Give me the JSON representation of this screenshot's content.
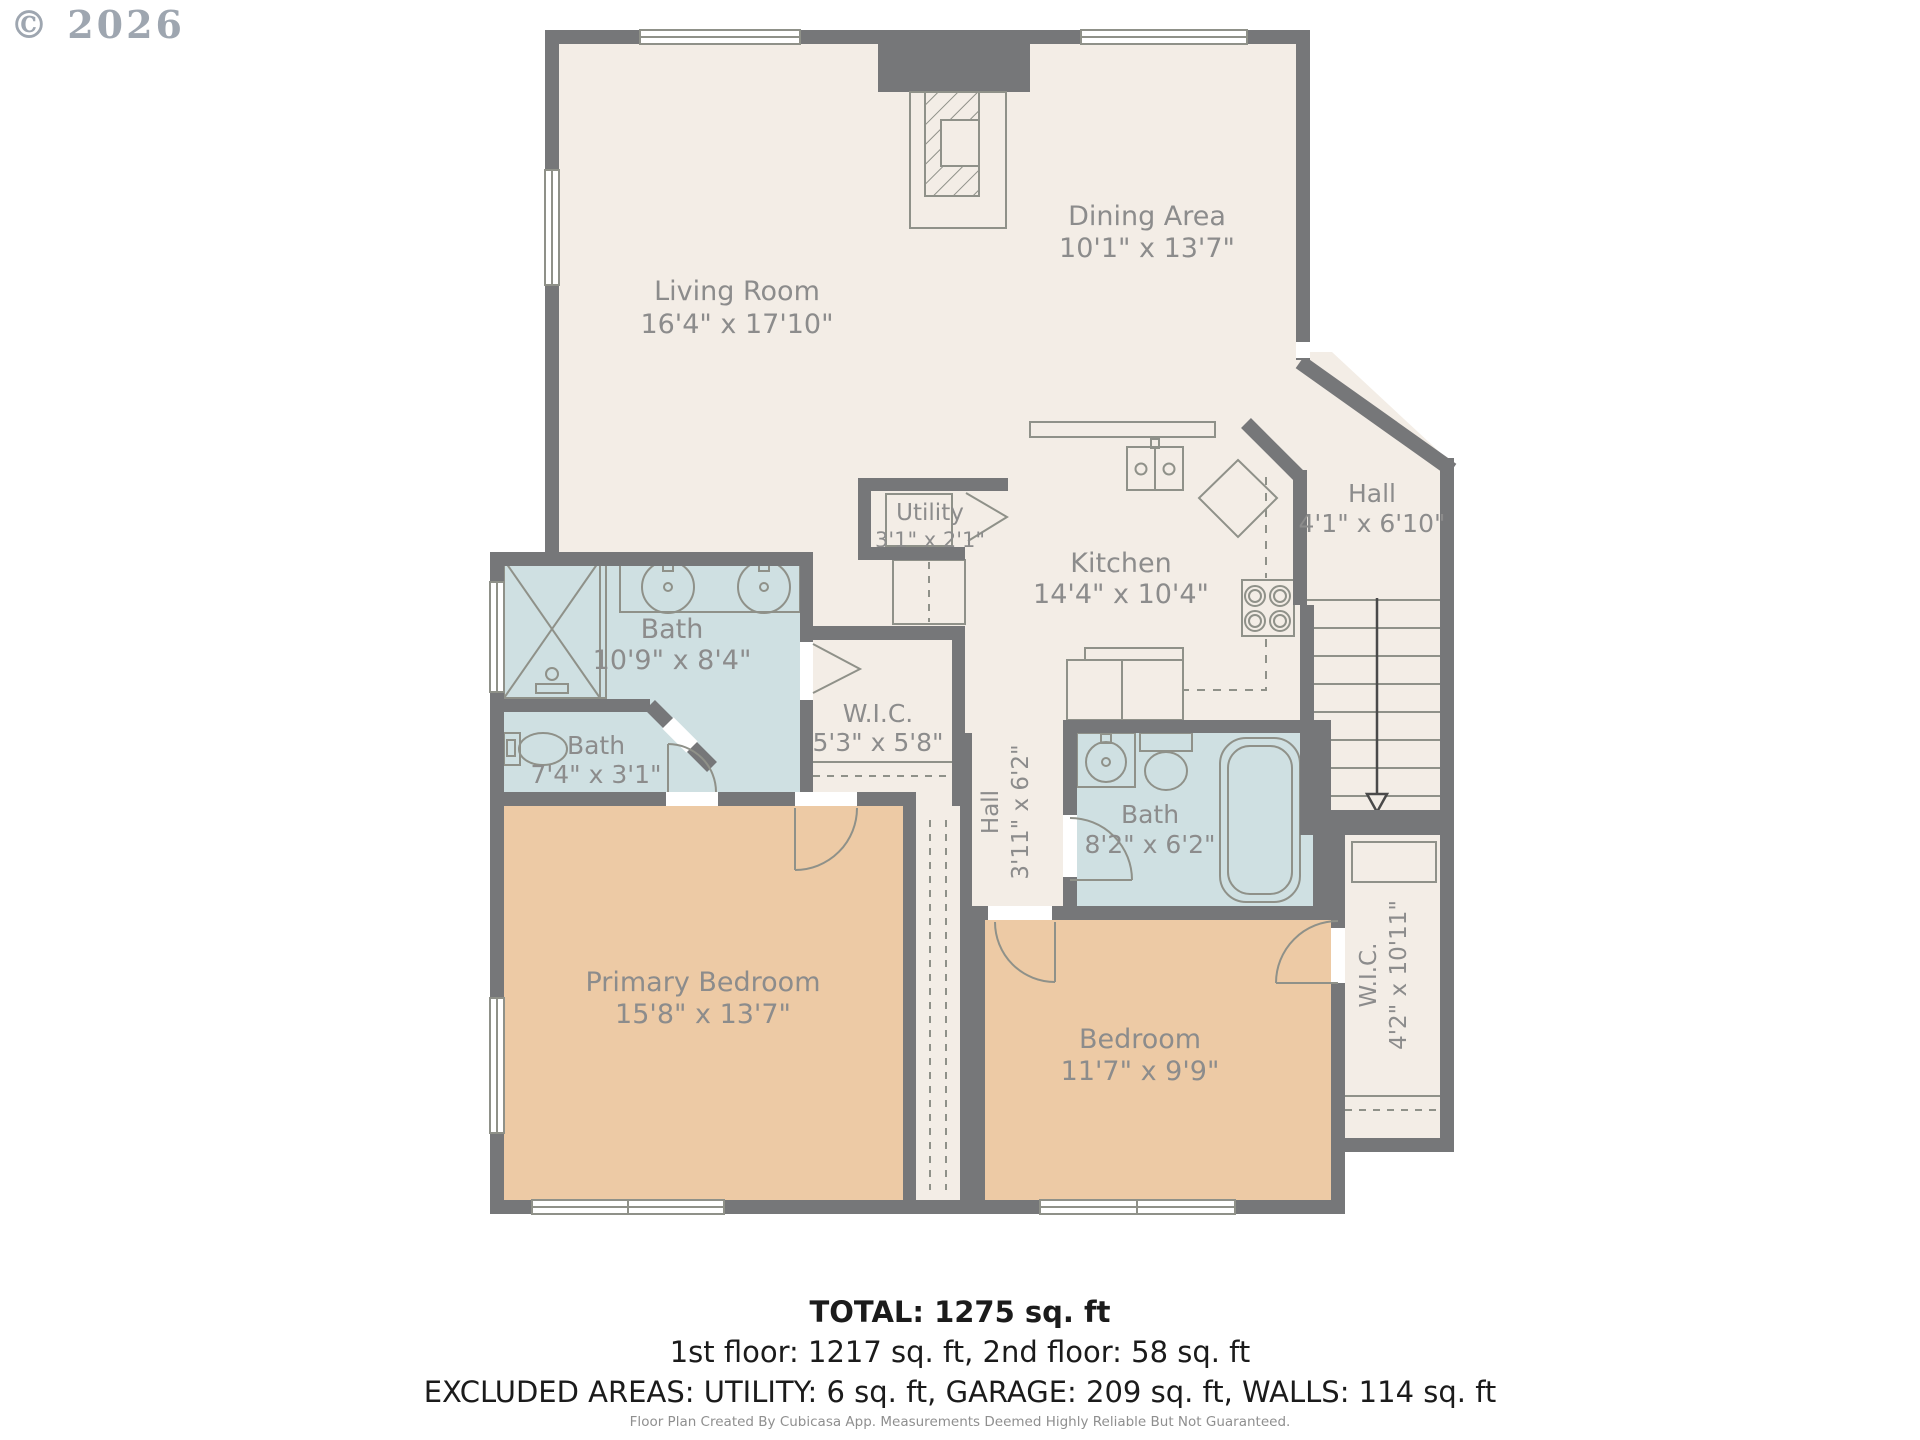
{
  "watermark": {
    "copyright": "© 2026"
  },
  "floorplan": {
    "rooms": {
      "living": {
        "name": "Living Room",
        "dims": "16'4\" x 17'10\""
      },
      "dining": {
        "name": "Dining Area",
        "dims": "10'1\" x 13'7\""
      },
      "utility": {
        "name": "Utility",
        "dims": "3'1\" x 2'1\""
      },
      "kitchen": {
        "name": "Kitchen",
        "dims": "14'4\" x 10'4\""
      },
      "hall_upper": {
        "name": "Hall",
        "dims": "4'1\" x 6'10\""
      },
      "bath_main": {
        "name": "Bath",
        "dims": "10'9\" x 8'4\""
      },
      "bath_small": {
        "name": "Bath",
        "dims": "7'4\" x 3'1\""
      },
      "wic_small": {
        "name": "W.I.C.",
        "dims": "5'3\" x 5'8\""
      },
      "hall_lower": {
        "name": "Hall",
        "dims": "3'11\" x 6'2\""
      },
      "bath_hall": {
        "name": "Bath",
        "dims": "8'2\" x 6'2\""
      },
      "wic_large": {
        "name": "W.I.C.",
        "dims": "4'2\" x 10'11\""
      },
      "primary": {
        "name": "Primary Bedroom",
        "dims": "15'8\" x 13'7\""
      },
      "bedroom": {
        "name": "Bedroom",
        "dims": "11'7\" x 9'9\""
      }
    },
    "colors": {
      "wall": "#767779",
      "floor": "#f3ede6",
      "bath": "#cfe0e2",
      "bedroom": "#edcaa5"
    }
  },
  "summary": {
    "total": "TOTAL: 1275 sq. ft",
    "floors": "1st floor: 1217 sq. ft, 2nd floor: 58 sq. ft",
    "excluded": "EXCLUDED AREAS: UTILITY: 6 sq. ft, GARAGE: 209 sq. ft, WALLS: 114 sq. ft"
  },
  "footer": "Floor Plan Created By Cubicasa App. Measurements Deemed Highly Reliable But Not Guaranteed."
}
